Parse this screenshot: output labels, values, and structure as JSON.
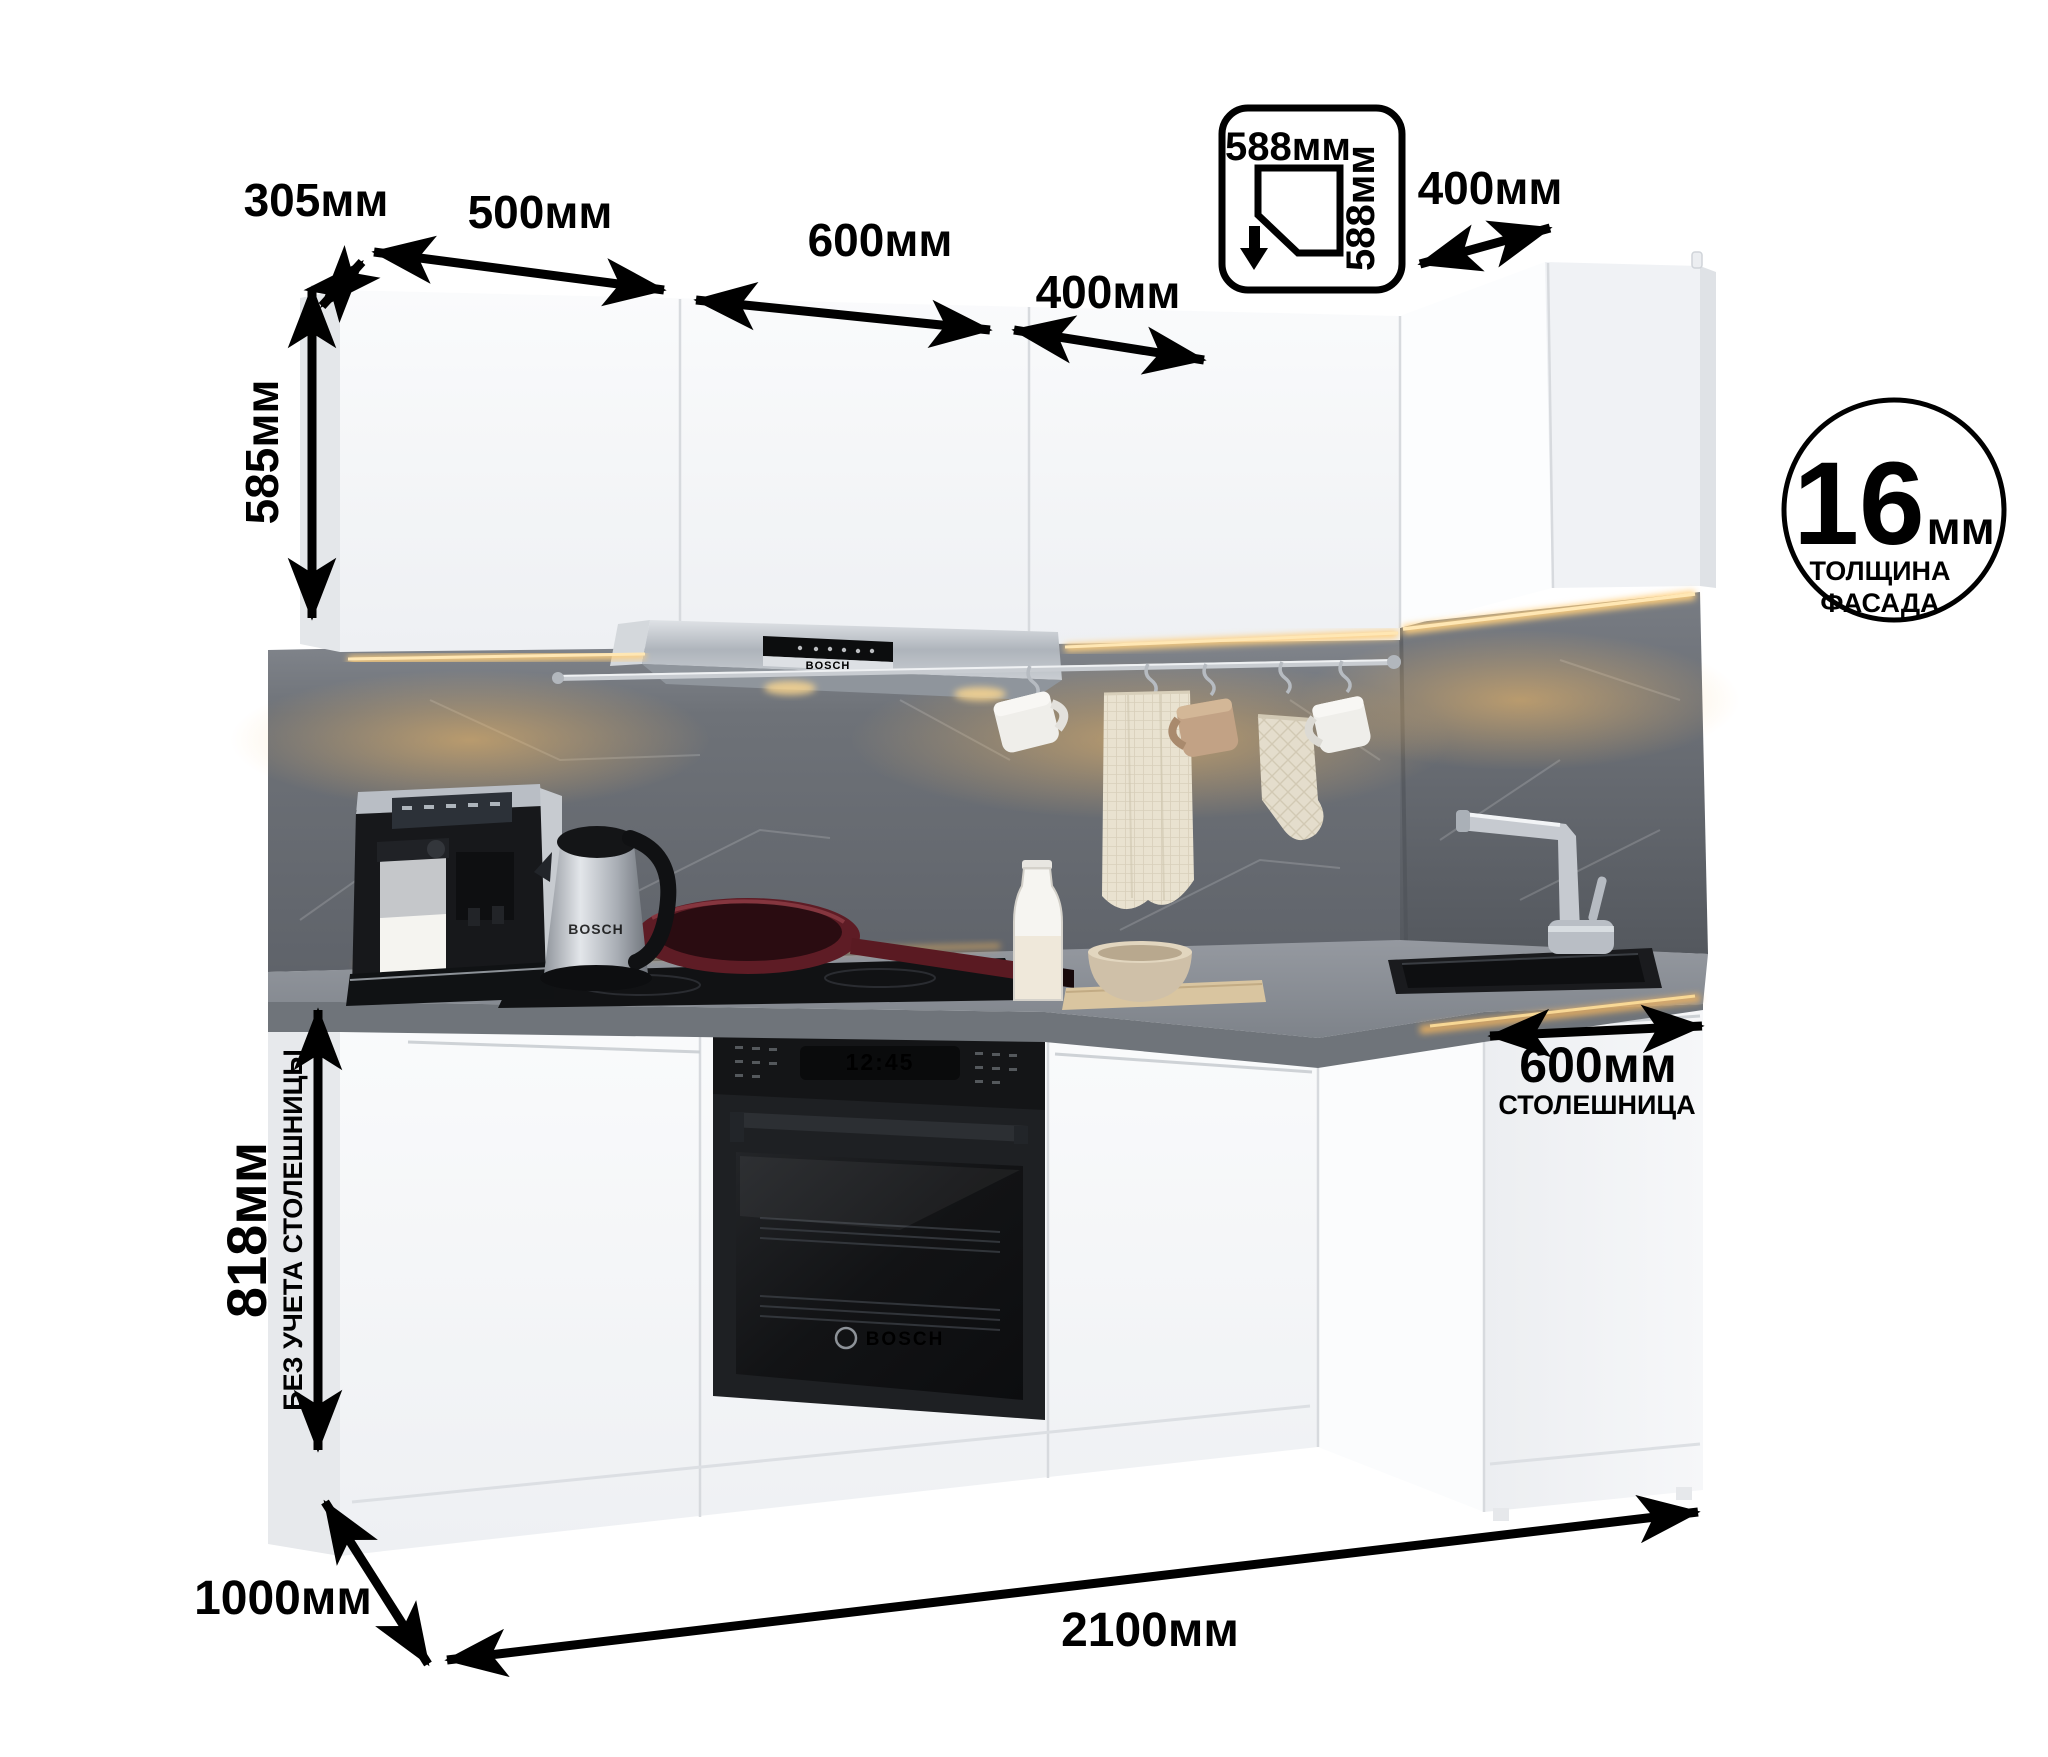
{
  "annotations": {
    "upper_depth": "305мм",
    "upper_widths": [
      "500мм",
      "600мм",
      "400мм"
    ],
    "corner_cabinet": {
      "width": "588мм",
      "depth": "588мм"
    },
    "right_width": "400мм",
    "upper_height": "585мм",
    "base_height": "818мм",
    "base_height_note": "БЕЗ УЧЕТА СТОЛЕШНИЦЫ",
    "floor_depth": "1000мм",
    "total_width": "2100мм",
    "worktop": {
      "width": "600мм",
      "label": "СТОЛЕШНИЦА"
    },
    "facade_badge": {
      "value": "16",
      "unit": "мм",
      "line1": "ТОЛЩИНА",
      "line2": "ФАСАДА"
    }
  },
  "appliances": {
    "hood_brand": "BOSCH",
    "oven_brand": "BOSCH",
    "oven_clock": "12:45",
    "kettle_brand": "BOSCH"
  },
  "colors": {
    "background": "#ffffff",
    "annotation": "#000000",
    "cabinet_white": "#f4f5f7",
    "backsplash_gray": "#6e7278",
    "countertop_gray": "#8d9299",
    "led_warm": "#ffcf7d",
    "appliance_black": "#1a1c1f",
    "stainless": "#b9bec5"
  }
}
